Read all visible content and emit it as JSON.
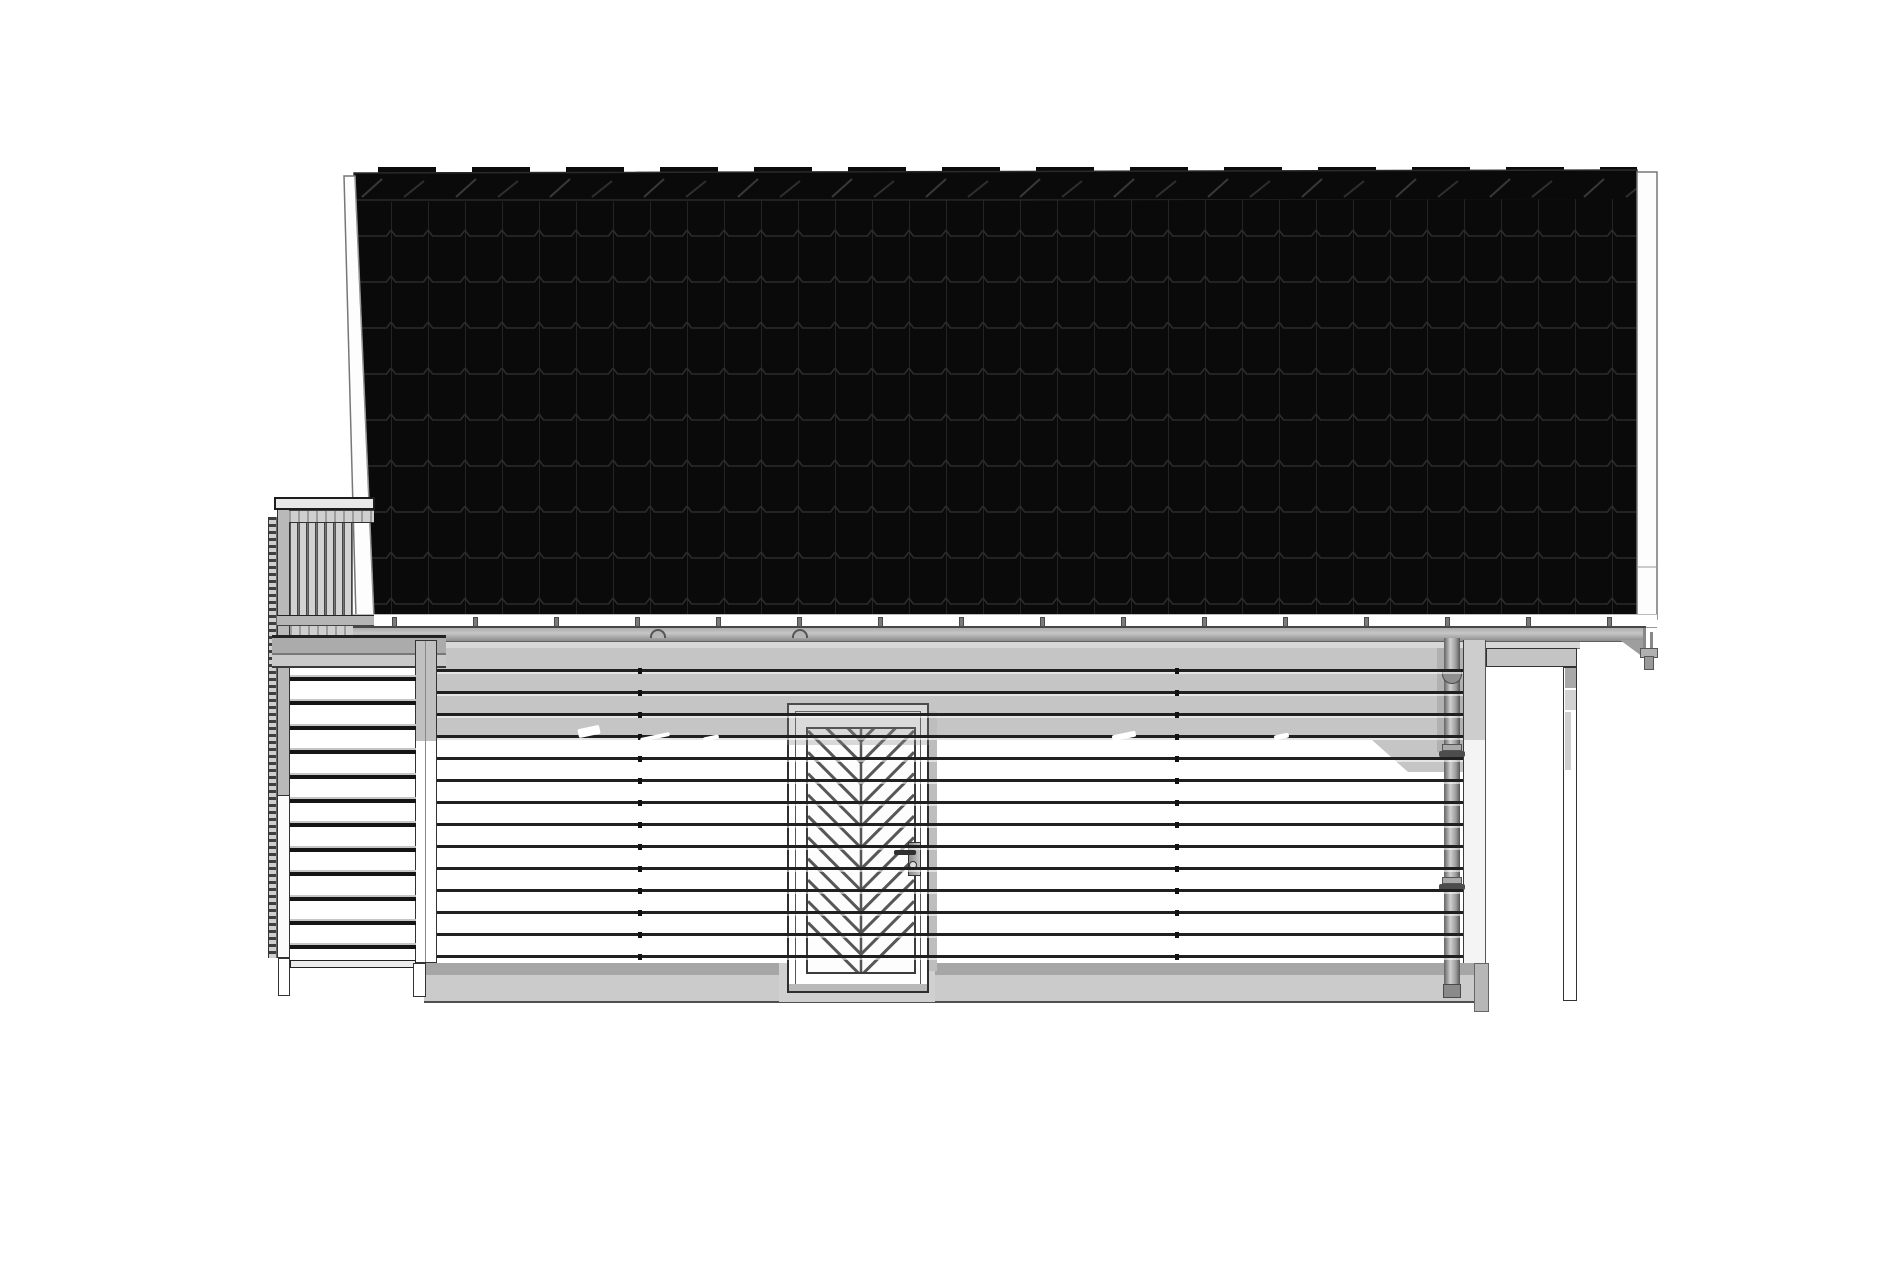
{
  "canvas": {
    "width": 1900,
    "height": 1266,
    "background": "#ffffff"
  },
  "palette": {
    "roof_tile": "#0a0a0a",
    "roof_tile_line": "#2b2b2b",
    "ridge_highlight": "#3a3a3a",
    "bargeboard": "#fdfdfd",
    "outline_dark": "#2e2e2e",
    "fascia": "#ffffff",
    "gutter_light": "#c6c6c6",
    "gutter_dark": "#8c8c8c",
    "wall_sunlit": "#ffffff",
    "wall_shadow": "#c5c5c5",
    "wall_shadow_dark": "#b1b1b1",
    "siding_line": "#202020",
    "foundation_dark": "#a6a6a6",
    "foundation": "#cbcbcb",
    "post_gray": "#b9b9b9",
    "tread": "#151515",
    "chevron": "#575757",
    "pipe_mid": "#cfcfcf"
  },
  "roof": {
    "left": 340,
    "top": 165,
    "width": 1322,
    "height": 500,
    "tile_col_px": 37,
    "tile_row_px": 46,
    "ridge_cap_px": 94
  },
  "gutter": {
    "bracket_count": 16,
    "bracket_start_x": 392,
    "bracket_step": 81,
    "bracket_y": 617,
    "union_arcs_x": [
      650,
      792
    ]
  },
  "siding": {
    "line_count": 14,
    "first_line_y": 669,
    "line_step": 22,
    "left": 437,
    "width": 1026,
    "joint_tick_columns": [
      638,
      1175
    ],
    "glints": [
      [
        578,
        727,
        22,
        9
      ],
      [
        640,
        735,
        30,
        4
      ],
      [
        703,
        736,
        16,
        4
      ],
      [
        1112,
        733,
        24,
        6
      ],
      [
        1274,
        734,
        15,
        5
      ]
    ]
  },
  "door": {
    "chevron_count": 13,
    "chevron_step": 21.3,
    "chevron_first_apex": -9,
    "panel": {
      "x": 806,
      "y": 727,
      "w": 106,
      "h": 243
    }
  },
  "stair": {
    "tread_count": 12,
    "tread_first_y": 677,
    "tread_step": 24.4,
    "tread_left": 290,
    "tread_width": 126
  },
  "balcony": {
    "baluster_count": 7,
    "baluster_step": 9,
    "baluster_width": 6,
    "baluster_top": 523,
    "baluster_height": 92,
    "baluster_left": 290
  }
}
